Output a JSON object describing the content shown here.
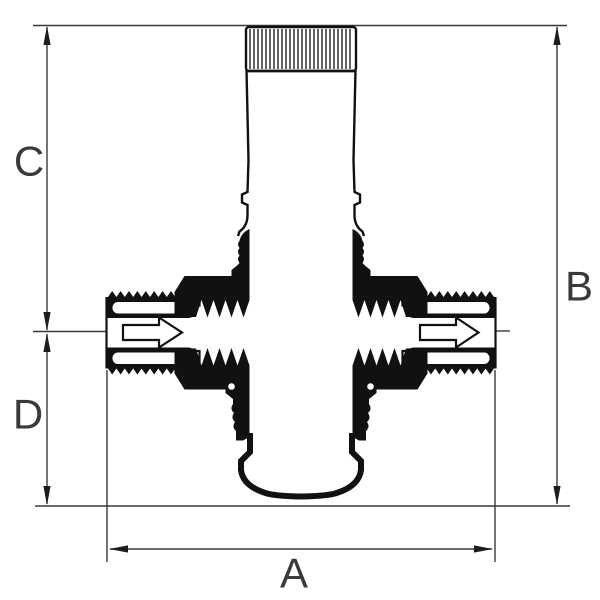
{
  "diagram": {
    "title": "pressure-reducing-valve-dimension-drawing",
    "labels": {
      "a": "A",
      "b": "B",
      "c": "C",
      "d": "D"
    },
    "icons": {
      "flow_inlet": "flow-direction-arrow-icon",
      "flow_outlet": "flow-direction-arrow-icon"
    },
    "colors": {
      "background": "#ffffff",
      "dimension_lines": "#3a3a3a",
      "drawing": "#111111"
    }
  }
}
